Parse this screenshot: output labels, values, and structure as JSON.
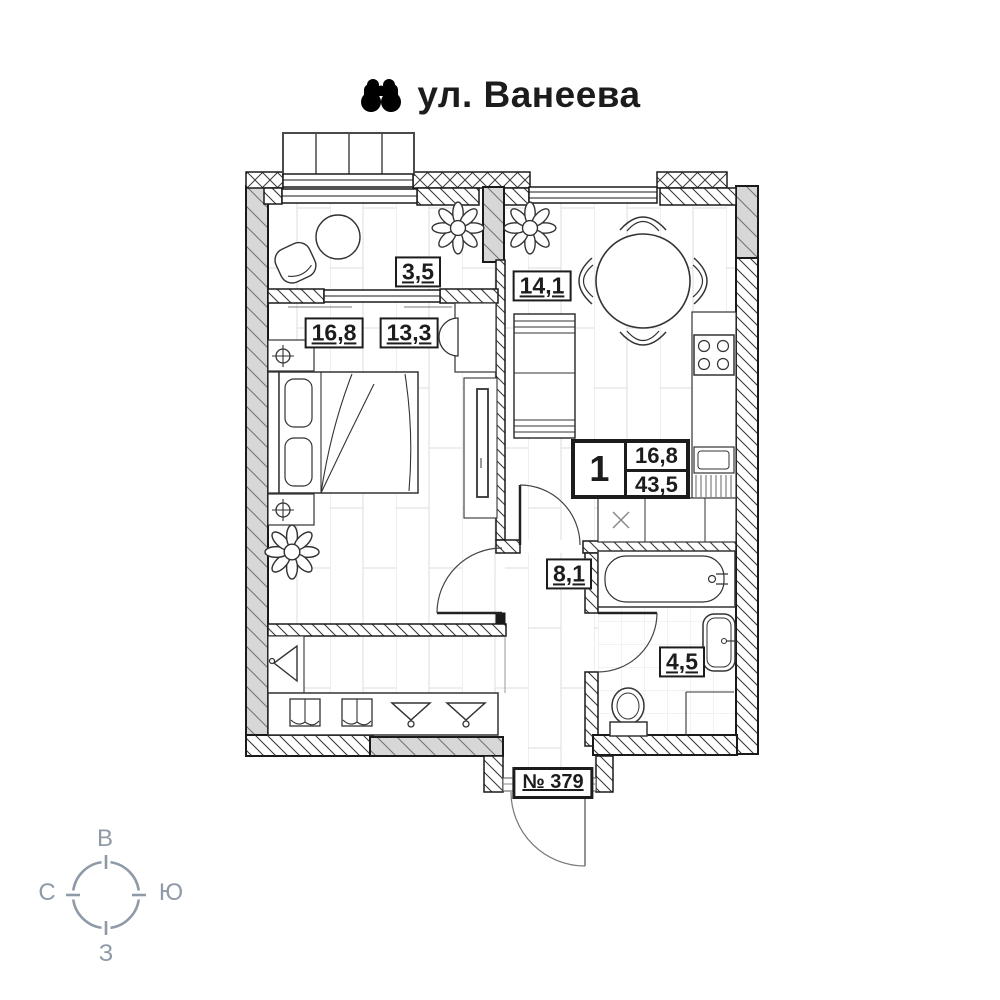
{
  "header": {
    "title": "ул. Ванеева",
    "icon": "binoculars-icon"
  },
  "plan": {
    "labels": {
      "loggia": "3,5",
      "kitchen": "14,1",
      "room_main": "16,8",
      "room_alt": "13,3",
      "hall": "8,1",
      "bathroom": "4,5"
    },
    "info": {
      "rooms_count": "1",
      "living_area": "16,8",
      "total_area": "43,5"
    },
    "apartment_number": "№ 379"
  },
  "compass": {
    "top": "В",
    "left": "С",
    "right": "Ю",
    "bottom": "З",
    "color": "#8f9aa8"
  }
}
